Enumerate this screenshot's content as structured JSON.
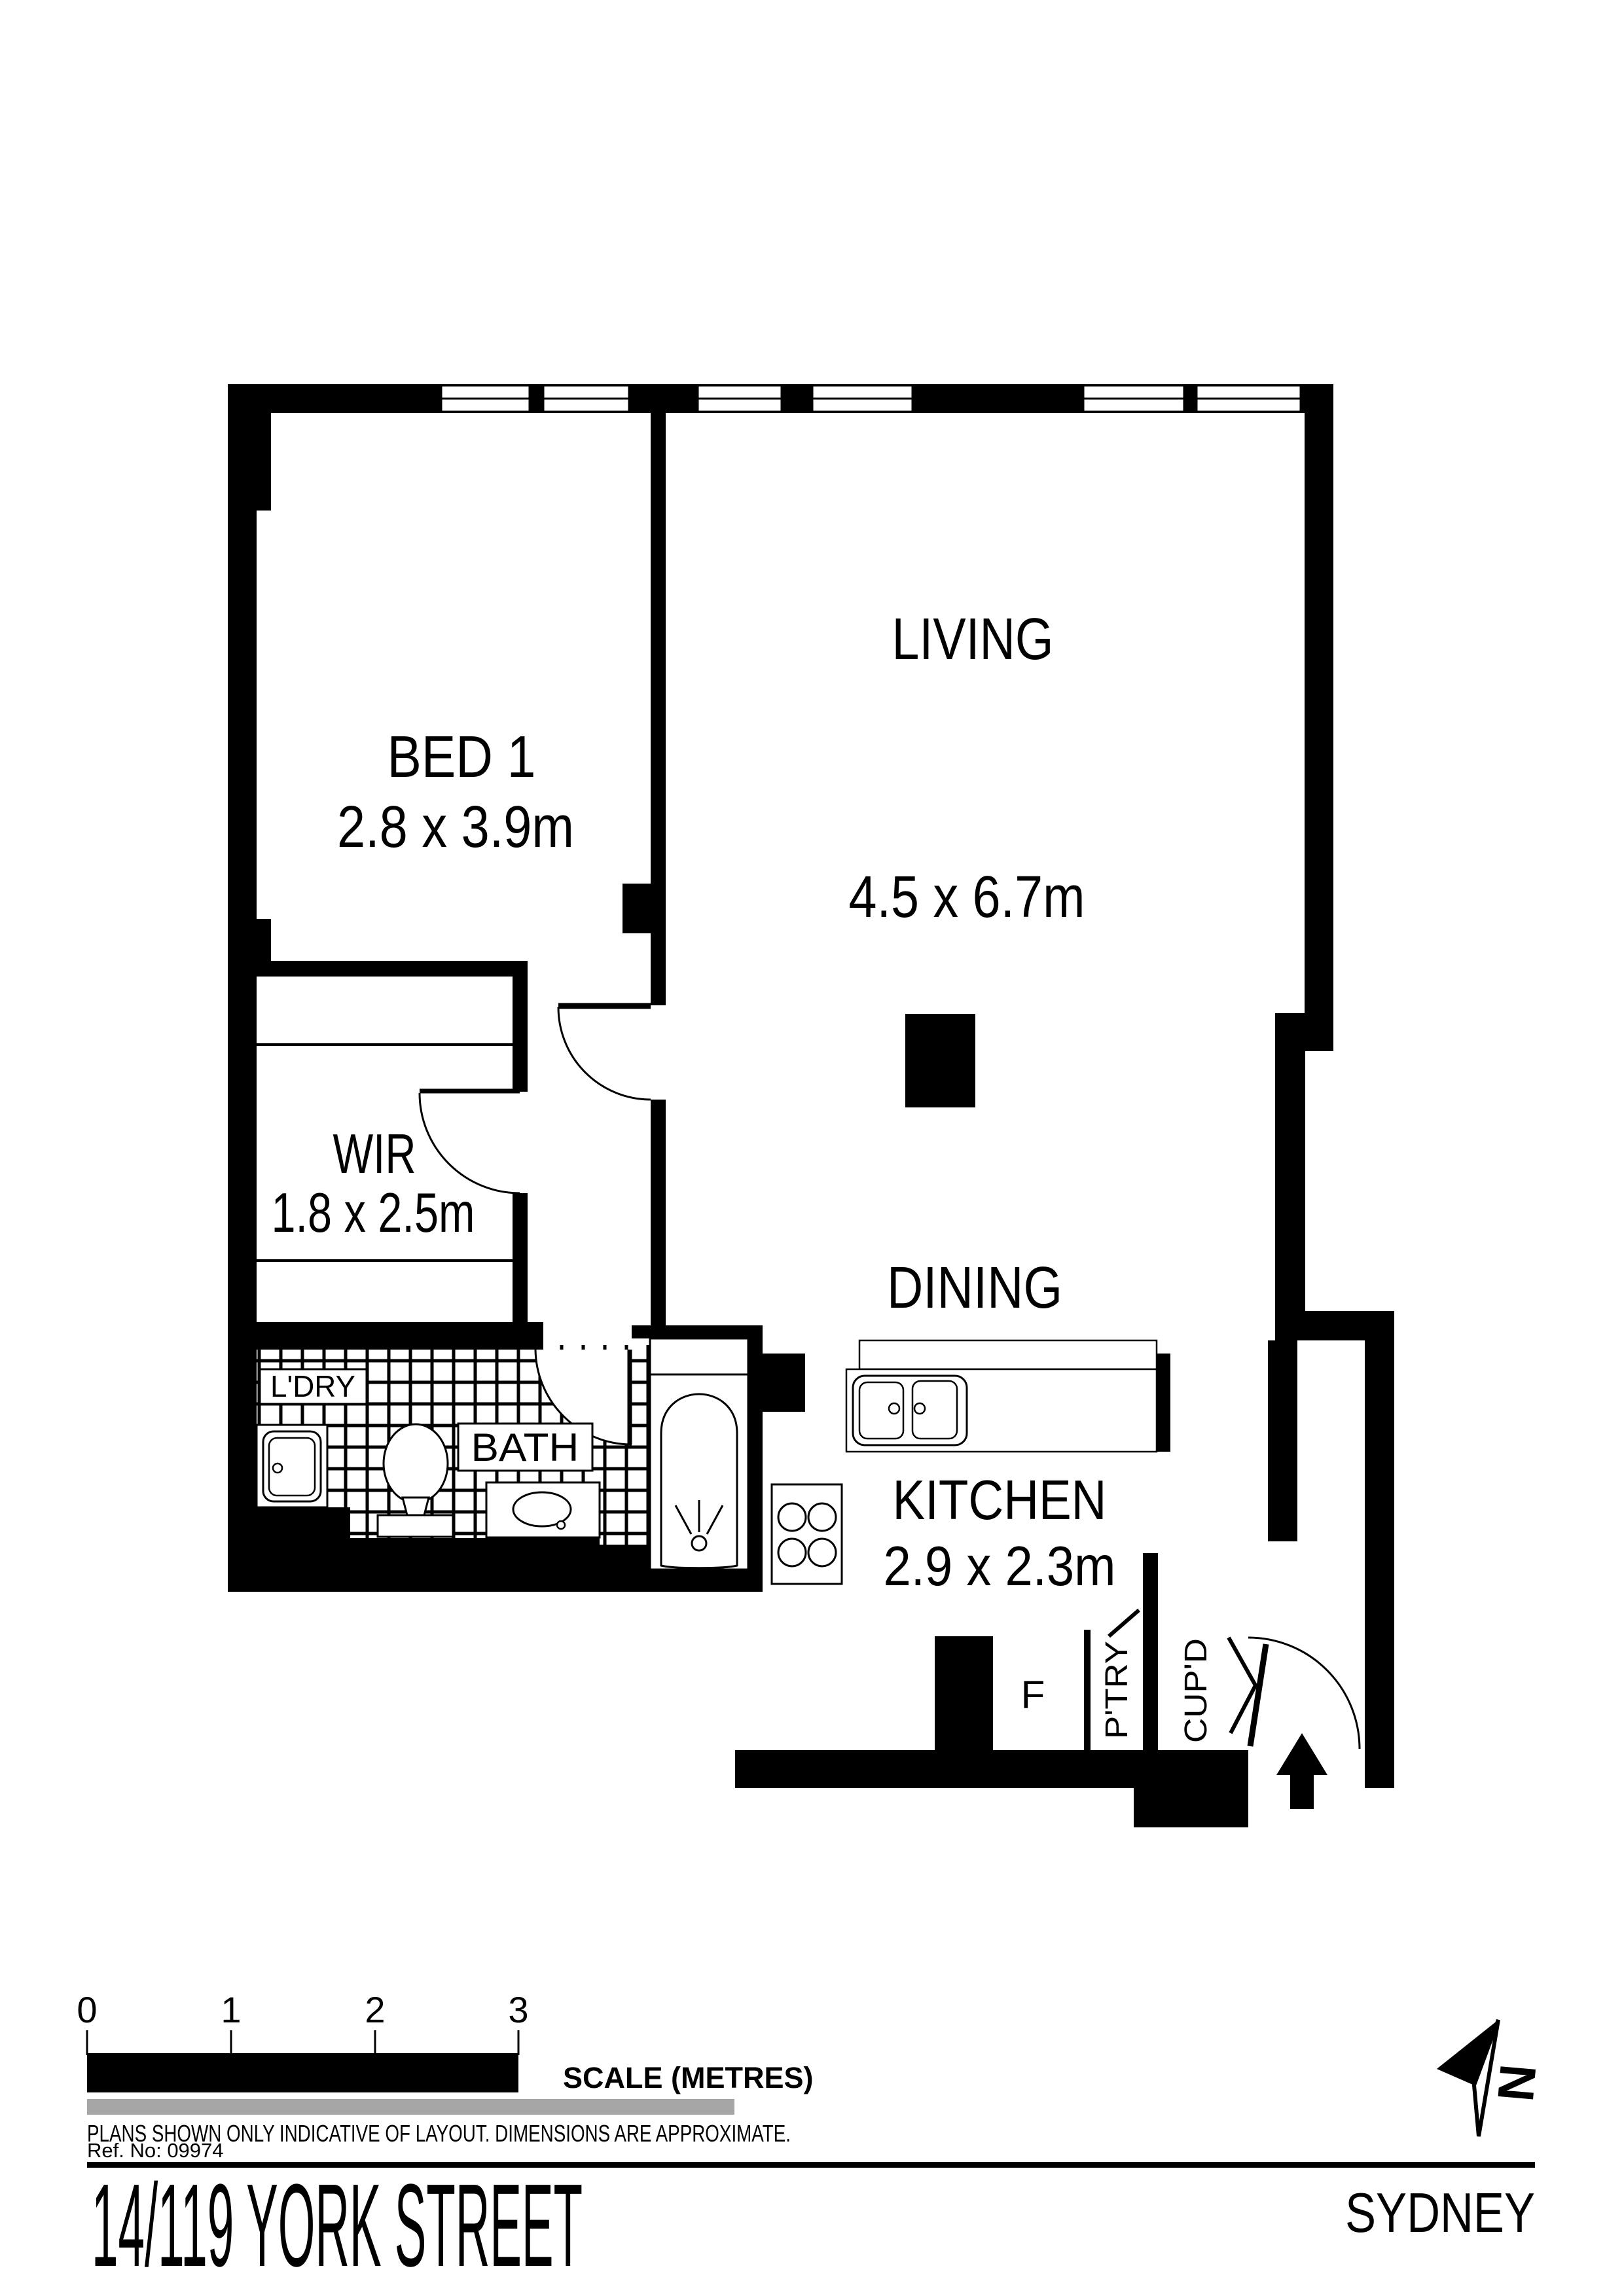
{
  "rooms": {
    "bed1": {
      "name": "BED 1",
      "dims": "2.8 x 3.9m"
    },
    "living": {
      "name": "LIVING",
      "dims": "4.5 x 6.7m"
    },
    "dining": {
      "name": "DINING"
    },
    "wir": {
      "name": "WIR",
      "dims": "1.8 x 2.5m"
    },
    "kitchen": {
      "name": "KITCHEN",
      "dims": "2.9 x 2.3m"
    },
    "bath": {
      "name": "BATH"
    },
    "laundry": {
      "name": "L'DRY"
    },
    "fridge": {
      "name": "F"
    },
    "pantry": {
      "name": "P'TRY"
    },
    "cupboard": {
      "name": "CUP'D"
    }
  },
  "scale_bar": {
    "ticks": [
      "0",
      "1",
      "2",
      "3"
    ],
    "label": "SCALE (METRES)"
  },
  "north_indicator": {
    "letter": "N"
  },
  "title_block": {
    "disclaimer": "PLANS SHOWN ONLY INDICATIVE OF LAYOUT.  DIMENSIONS ARE APPROXIMATE.",
    "reference": "Ref. No: 09974",
    "address": "14/119 YORK STREET",
    "city": "SYDNEY"
  },
  "colors": {
    "wall": "#000000",
    "fixture_outline": "#000000",
    "scale_gray": "#a6a6a6",
    "background": "#ffffff"
  }
}
